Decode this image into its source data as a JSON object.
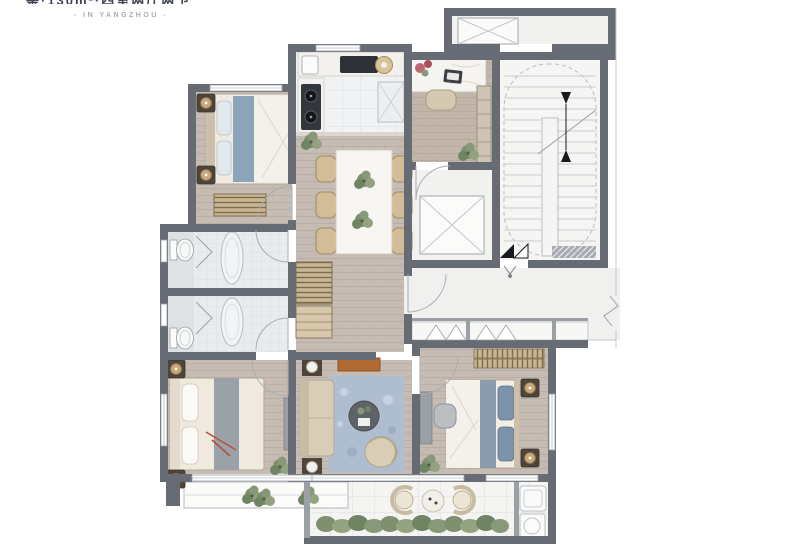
{
  "header": {
    "title_clipped": "鉴·130m²·四室两厅两卫",
    "subtitle": "- IN YANGZHOU -"
  },
  "floor_plan": {
    "type": "apartment-floor-plan",
    "area_label": "130m²",
    "location_text": "IN YANGZHOU",
    "rooms": [
      {
        "id": "bedroom-2",
        "position": "top-left",
        "furniture": [
          "double-bed",
          "nightstand-lamps",
          "striped-bench"
        ]
      },
      {
        "id": "kitchen",
        "position": "top-center",
        "furniture": [
          "sink",
          "cooktop",
          "refrigerator",
          "counter"
        ]
      },
      {
        "id": "study",
        "position": "top-right",
        "furniture": [
          "desk-with-flowers",
          "laptop",
          "chair",
          "bookshelf",
          "plant"
        ]
      },
      {
        "id": "dining-room",
        "position": "center",
        "furniture": [
          "dining-table",
          "six-chairs",
          "table-plants"
        ]
      },
      {
        "id": "bathroom-1",
        "position": "mid-left-upper",
        "furniture": [
          "toilet",
          "shower",
          "oval-tub"
        ]
      },
      {
        "id": "bathroom-2",
        "position": "mid-left-lower",
        "furniture": [
          "toilet",
          "shower",
          "oval-tub"
        ]
      },
      {
        "id": "hallway",
        "position": "center",
        "furniture": [
          "striped-sideboard"
        ]
      },
      {
        "id": "master-bedroom",
        "position": "bottom-left",
        "furniture": [
          "king-bed",
          "nightstand-lamps",
          "console",
          "plant"
        ]
      },
      {
        "id": "living-room",
        "position": "bottom-center",
        "furniture": [
          "sofa",
          "blue-rug",
          "round-coffee-table",
          "lounge-chair",
          "tv-console",
          "lamp-tables"
        ]
      },
      {
        "id": "bedroom-3",
        "position": "bottom-right",
        "furniture": [
          "double-bed",
          "nightstand-lamps",
          "wardrobe",
          "desk",
          "chair",
          "plant"
        ]
      },
      {
        "id": "balcony",
        "position": "bottom",
        "furniture": [
          "wicker-chairs",
          "round-table",
          "hedge-plants",
          "laundry-sink",
          "washer"
        ]
      },
      {
        "id": "bay-window",
        "position": "below-master-bedroom",
        "furniture": [
          "plants"
        ]
      },
      {
        "id": "stairwell",
        "position": "right",
        "furniture": [
          "u-shaped-stairs",
          "direction-arrows"
        ]
      },
      {
        "id": "elevator",
        "position": "right-center",
        "furniture": [
          "elevator-shaft-x"
        ]
      },
      {
        "id": "entry-corridor",
        "position": "right-lower",
        "furniture": [
          "entry-door-mark",
          "duct-closets"
        ]
      },
      {
        "id": "service-corridor",
        "position": "top-right",
        "furniture": [
          "shaft-x"
        ]
      }
    ],
    "palette": {
      "wall": "#676c74",
      "wood_floor": "#c6bcb3",
      "kitchen_tile": "#f0f2f3",
      "bath_tile": "#e9ebed",
      "corridor_floor": "#f0f0ee",
      "stair_floor": "#f5f5f3",
      "balcony_tile": "#f4f4f2",
      "rug_blue": "#aebdd0",
      "bed_blue": "#8ca4ba",
      "sofa_tan": "#d9cdb8",
      "tv_orange": "#b06a33",
      "plant_green": "#7d8f6e",
      "lamp_tan": "#c9a87e",
      "fixture_line": "#9aa0a6"
    }
  }
}
